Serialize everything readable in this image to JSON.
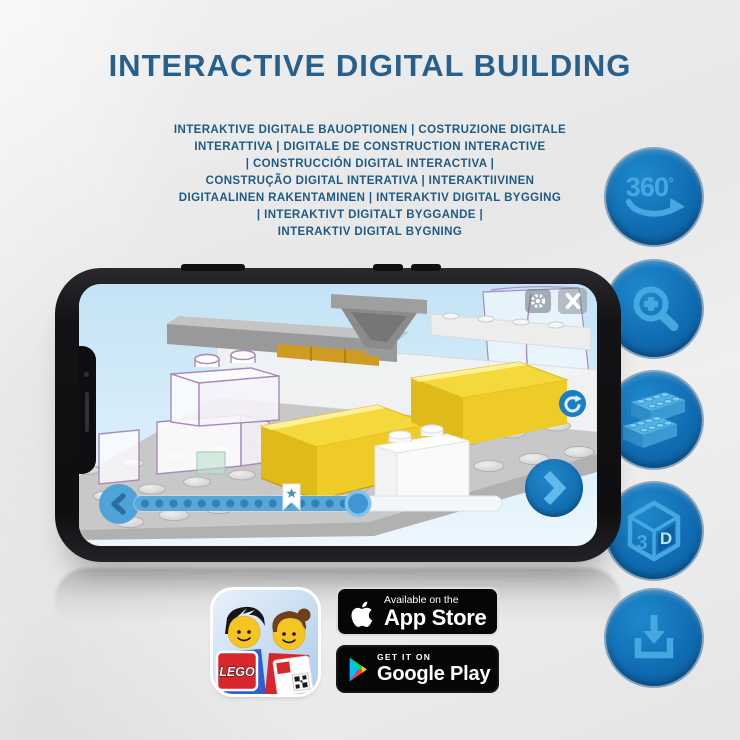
{
  "header": {
    "title": "INTERACTIVE DIGITAL BUILDING",
    "subtitle_lines": [
      "INTERAKTIVE DIGITALE BAUOPTIONEN | COSTRUZIONE DIGITALE",
      "INTERATTIVA | DIGITALE DE CONSTRUCTION INTERACTIVE",
      "| CONSTRUCCIÓN DIGITAL INTERACTIVA |",
      "CONSTRUÇÃO DIGITAL INTERATIVA | INTERAKTIIVINEN",
      "DIGITAALINEN RAKENTAMINEN | INTERAKTIV DIGITAL BYGGING",
      "| INTERAKTIVT DIGITALT BYGGANDE |",
      "INTERAKTIV DIGITAL BYGNING"
    ]
  },
  "features": {
    "rotate_label": "360",
    "rotate_degree": "°",
    "cube_left": "3",
    "cube_right": "D"
  },
  "store": {
    "app_store": {
      "tagline": "Available on the",
      "name": "App Store"
    },
    "google_play": {
      "tagline": "GET IT ON",
      "name": "Google Play"
    },
    "lego_logo_text": "LEGO"
  },
  "colors": {
    "background": "#e9e9e9",
    "title_blue": "#275f8d",
    "subtitle_blue": "#1e5a85",
    "feature_circle_blue": "#1277bd",
    "feature_glyph_blue": "#45a8e0",
    "app_accent_blue": "#1d82c6",
    "highlight_yellow": "#f2d335",
    "badge_black": "#060606"
  }
}
